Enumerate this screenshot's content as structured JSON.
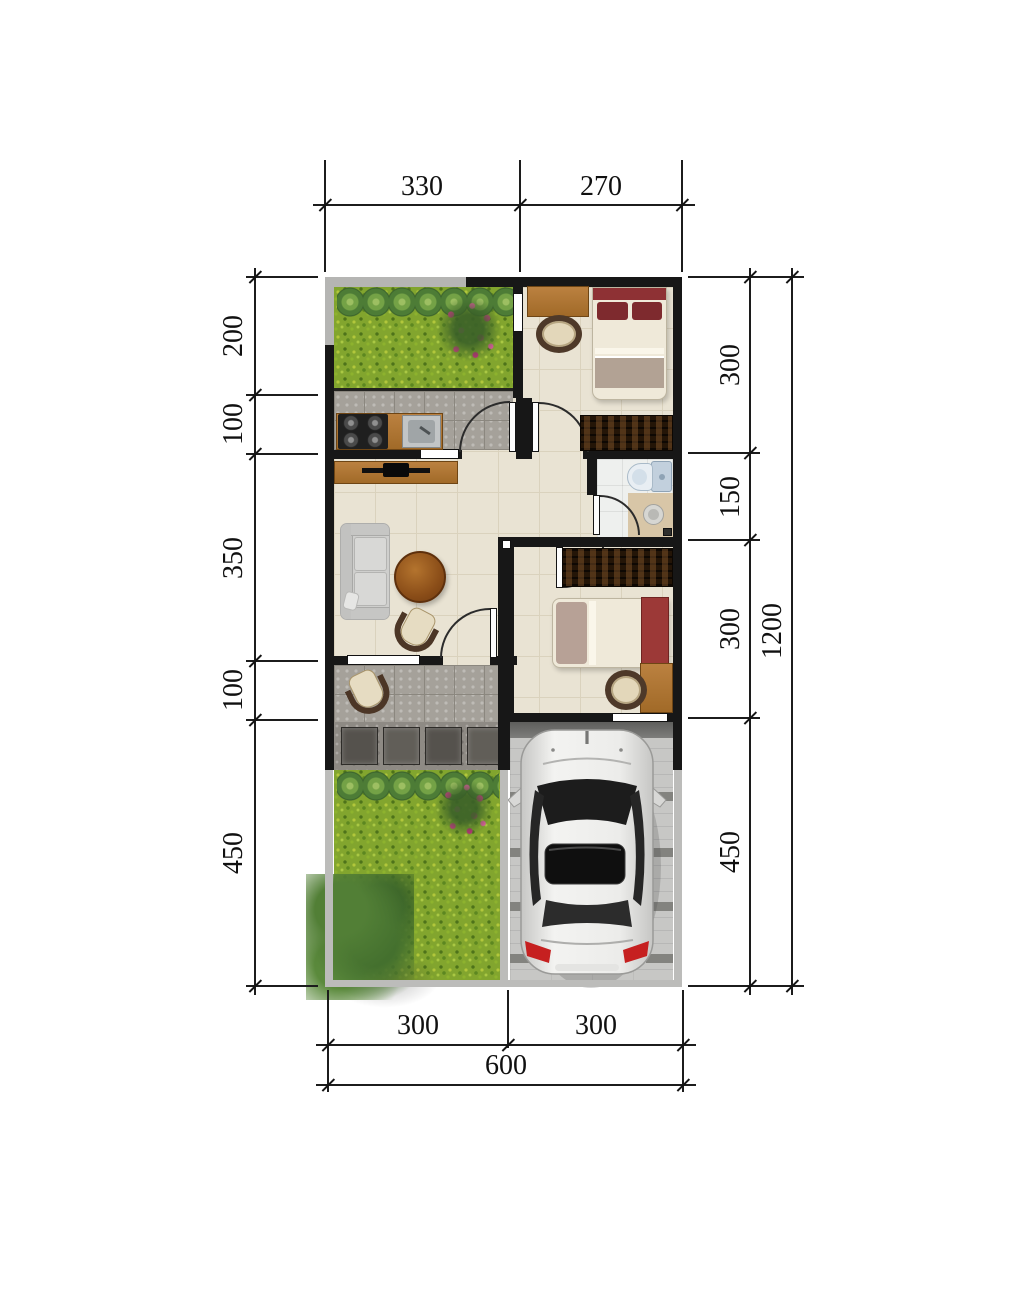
{
  "title": "house-floor-plan",
  "plan_type": "single-storey house plan with carport and gardens",
  "dims": {
    "top": [
      "330",
      "270"
    ],
    "left": [
      "200",
      "100",
      "350",
      "100",
      "450"
    ],
    "right": [
      "300",
      "150",
      "300",
      "450"
    ],
    "right_total": "1200",
    "bottom": [
      "300",
      "300"
    ],
    "bottom_total": "600"
  },
  "colors": {
    "wall": "#171717",
    "outdoor_wall_gray": "#b5b5b3",
    "grass_green": "#82a52e",
    "floor_cream": "#e9e3d3",
    "floor_stone_gray": "#a5a19a",
    "wood_brown": "#a9722e",
    "bed_maroon": "#8e3134",
    "flower_pink": "#d8348e",
    "taillight_red": "#c62020",
    "car_silver": "#e9e9e7"
  }
}
